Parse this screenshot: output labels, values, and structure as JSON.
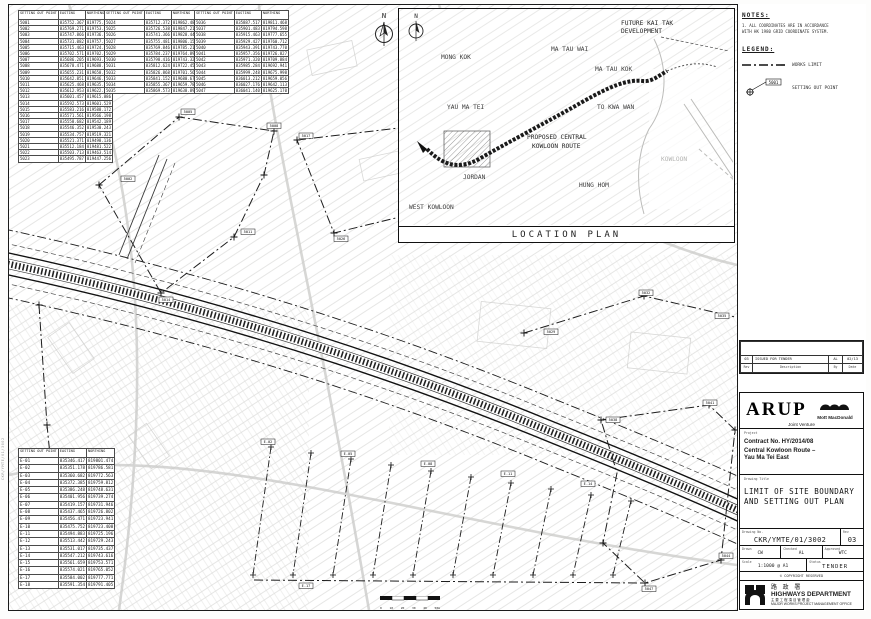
{
  "sheet": {
    "margin_note": "CKR/YMTE/01/3002"
  },
  "north": {
    "label": "N"
  },
  "notes": {
    "title": "NOTES:",
    "line1": "1. ALL COORDINATES ARE IN ACCORDANCE",
    "line2": "   WITH HK 1980 GRID COORDINATE SYSTEM."
  },
  "legend": {
    "title": "LEGEND:",
    "works_limit": "WORKS LIMIT",
    "setting_out_point": "SETTING OUT POINT",
    "sample_point_id": "5001"
  },
  "location_plan": {
    "title": "LOCATION PLAN",
    "areas": {
      "mong_kok": "MONG KOK",
      "yau_ma_tei": "YAU MA TEI",
      "jordan": "JORDAN",
      "west_kowloon": "WEST KOWLOON",
      "ma_tau_wai": "MA TAU WAI",
      "ma_tau_kok": "MA TAU KOK",
      "to_kwa_wan": "TO KWA WAN",
      "hung_hom": "HUNG HOM",
      "kowloon": "KOWLOON"
    },
    "future_1": "FUTURE KAI TAK",
    "future_2": "DEVELOPMENT",
    "route_1": "PROPOSED CENTRAL",
    "route_2": "KOWLOON ROUTE"
  },
  "scalebar": {
    "labels": [
      "0",
      "10",
      "20",
      "30",
      "40",
      "50m"
    ]
  },
  "tables": {
    "headers": [
      "SETTING OUT POINT",
      "EASTING",
      "NORTHING"
    ],
    "table_a": [
      [
        "5001",
        "835752.367",
        "819775.556"
      ],
      [
        "5002",
        "835769.271",
        "819753.447"
      ],
      [
        "5003",
        "835747.866",
        "819736.358"
      ],
      [
        "5004",
        "835731.082",
        "819757.014"
      ],
      [
        "5005",
        "835715.463",
        "819724.675"
      ],
      [
        "5006",
        "835702.571",
        "819702.476"
      ],
      [
        "5007",
        "835686.205",
        "819693.717"
      ],
      [
        "5008",
        "835678.471",
        "819688.549"
      ],
      [
        "5009",
        "835655.231",
        "819658.156"
      ],
      [
        "5010",
        "835642.851",
        "819646.367"
      ],
      [
        "5011",
        "835625.468",
        "819635.867"
      ],
      [
        "5012",
        "835612.953",
        "819622.745"
      ],
      [
        "5013",
        "835601.457",
        "819615.886"
      ],
      [
        "5014",
        "835592.573",
        "819601.529"
      ],
      [
        "5015",
        "835583.216",
        "819588.172"
      ],
      [
        "5016",
        "835571.561",
        "819566.198"
      ],
      [
        "5017",
        "835558.682",
        "819542.189"
      ],
      [
        "5018",
        "835546.352",
        "819530.243"
      ],
      [
        "5019",
        "835534.757",
        "819519.321"
      ],
      [
        "5020",
        "835521.371",
        "819498.136"
      ],
      [
        "5021",
        "835512.184",
        "819481.522"
      ],
      [
        "5022",
        "835503.713",
        "819463.514"
      ],
      [
        "5023",
        "835495.787",
        "819447.256"
      ]
    ],
    "table_b": [
      [
        "5024",
        "835712.372",
        "819862.488"
      ],
      [
        "5025",
        "835726.538",
        "819847.215"
      ],
      [
        "5026",
        "835741.366",
        "819828.449"
      ],
      [
        "5027",
        "835755.481",
        "819806.154"
      ],
      [
        "5028",
        "835769.846",
        "819785.215"
      ],
      [
        "5029",
        "835784.237",
        "819764.892"
      ],
      [
        "5030",
        "835798.416",
        "819743.321"
      ],
      [
        "5031",
        "835812.624",
        "819722.458"
      ],
      [
        "5032",
        "835826.868",
        "819701.564"
      ],
      [
        "5033",
        "835841.152",
        "819680.672"
      ],
      [
        "5034",
        "835855.367",
        "819659.781"
      ],
      [
        "5035",
        "835869.573",
        "819638.897"
      ]
    ],
    "table_c": [
      [
        "5036",
        "835887.517",
        "819811.468"
      ],
      [
        "5037",
        "835901.483",
        "819794.598"
      ],
      [
        "5038",
        "835915.463",
        "819777.655"
      ],
      [
        "5039",
        "835929.427",
        "819760.712"
      ],
      [
        "5040",
        "835943.391",
        "819743.770"
      ],
      [
        "5041",
        "835957.356",
        "819726.827"
      ],
      [
        "5042",
        "835971.320",
        "819709.884"
      ],
      [
        "5043",
        "835985.284",
        "819692.941"
      ],
      [
        "5044",
        "835999.248",
        "819675.998"
      ],
      [
        "5045",
        "836013.212",
        "819659.056"
      ],
      [
        "5046",
        "836027.176",
        "819642.113"
      ],
      [
        "5047",
        "836041.140",
        "819625.170"
      ]
    ],
    "table_d": [
      [
        "E-01",
        "835346.417",
        "819801.474"
      ],
      [
        "E-02",
        "835351.178",
        "819786.581"
      ],
      [
        "E-03",
        "835360.682",
        "819772.563"
      ],
      [
        "E-04",
        "835372.385",
        "819759.812"
      ],
      [
        "E-05",
        "835386.248",
        "819748.631"
      ],
      [
        "E-06",
        "835401.956",
        "819739.274"
      ],
      [
        "E-07",
        "835419.157",
        "819731.946"
      ],
      [
        "E-08",
        "835437.465",
        "819726.802"
      ],
      [
        "E-09",
        "835456.471",
        "819723.941"
      ],
      [
        "E-10",
        "835475.752",
        "819723.408"
      ],
      [
        "E-11",
        "835494.883",
        "819725.196"
      ],
      [
        "E-12",
        "835513.442",
        "819729.243"
      ],
      [
        "E-13",
        "835531.017",
        "819735.437"
      ],
      [
        "E-14",
        "835547.212",
        "819743.616"
      ],
      [
        "E-15",
        "835561.659",
        "819753.571"
      ],
      [
        "E-16",
        "835574.021",
        "819765.052"
      ],
      [
        "E-17",
        "835584.002",
        "819777.771"
      ],
      [
        "E-18",
        "835591.354",
        "819791.405"
      ]
    ]
  },
  "plan": {
    "point_labels": [
      "5002",
      "5005",
      "5008",
      "5011",
      "5014",
      "5017",
      "5020",
      "5023",
      "5026",
      "5029",
      "5032",
      "5035",
      "5038",
      "5041",
      "5044",
      "5047",
      "E-02",
      "E-05",
      "E-08",
      "E-11",
      "E-14",
      "E-17"
    ]
  },
  "title_block": {
    "revision": {
      "rev": "03",
      "description": "ISSUED FOR TENDER",
      "by": "AL",
      "date": "02/13",
      "headers": {
        "rev": "Rev",
        "description": "Description",
        "by": "By",
        "date": "Date"
      }
    },
    "firm": {
      "arup": "ARUP",
      "mott": "Mott MacDonald",
      "jv": "Joint Venture"
    },
    "project": {
      "label": "Project",
      "contract": "Contract No. HY/2014/08",
      "name_1": "Central Kowloon Route –",
      "name_2": "Yau Ma Tei East"
    },
    "drawing_title": {
      "label": "Drawing Title",
      "line1": "LIMIT OF SITE BOUNDARY",
      "line2": "AND SETTING OUT PLAN"
    },
    "drawing_no": {
      "label": "Drawing No.",
      "value": "CKR/YMTE/01/3002",
      "rev_label": "Rev",
      "rev": "03"
    },
    "signoff": {
      "drawn_label": "Drawn",
      "drawn": "CW",
      "checked_label": "Checked",
      "checked": "AL",
      "approved_label": "Approved",
      "approved": "WTC"
    },
    "scale": {
      "label": "Scale",
      "value": "1:1000 @ A1",
      "status_label": "Status",
      "status": "TENDER"
    },
    "copyright": "© COPYRIGHT RESERVED",
    "department": {
      "name_cn": "路 政 署",
      "name_en": "HIGHWAYS DEPARTMENT",
      "office_cn": "主要工程項目管理處",
      "office_en": "MAJOR WORKS PROJECT MANAGEMENT OFFICE"
    }
  }
}
